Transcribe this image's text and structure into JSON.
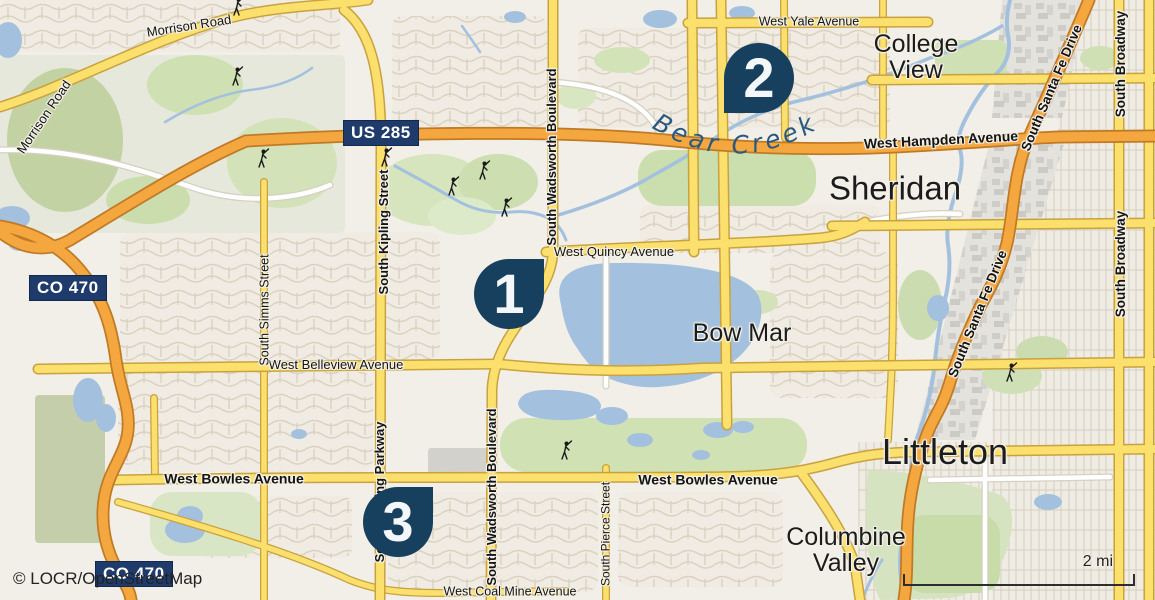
{
  "map": {
    "attribution": "© LOCR/OpenStreetMap",
    "scale": {
      "label": "2 mi"
    },
    "markers": [
      {
        "number": "1"
      },
      {
        "number": "2"
      },
      {
        "number": "3"
      }
    ],
    "shields": {
      "us285": "US 285",
      "co470_north": "CO 470",
      "co470_south": "CO 470"
    },
    "places": {
      "college_view": "College View",
      "sheridan": "Sheridan",
      "bow_mar": "Bow Mar",
      "littleton": "Littleton",
      "columbine_valley": "Columbine Valley"
    },
    "water_labels": {
      "bear_creek": "Bear Creek"
    },
    "road_labels": {
      "morrison_road_nw": "Morrison Road",
      "morrison_road_w": "Morrison Road",
      "west_yale_avenue": "West Yale Avenue",
      "west_hampden_avenue": "West Hampden Avenue",
      "west_quincy_avenue": "West Quincy Avenue",
      "west_belleview_avenue": "West Belleview Avenue",
      "west_bowles_avenue_w": "West Bowles Avenue",
      "west_bowles_avenue_e": "West Bowles Avenue",
      "west_coal_mine_avenue": "West Coal Mine Avenue",
      "south_simms_street": "South Simms Street",
      "south_kipling_street": "South Kipling Street",
      "south_kipling_parkway": "South Kipling Parkway",
      "south_wadsworth_boulevard_n": "South Wadsworth Boulevard",
      "south_wadsworth_boulevard_s": "South Wadsworth Boulevard",
      "south_pierce_street": "South Pierce Street",
      "south_santa_fe_drive_n": "South Santa Fe Drive",
      "south_santa_fe_drive_s": "South Santa Fe Drive",
      "south_broadway_n": "South Broadway",
      "south_broadway_s": "South Broadway"
    },
    "colors": {
      "marker": "#17405E",
      "shield": "#1F3B6B",
      "water": "#A3C1DE",
      "highway_orange": "#F5A73F",
      "road_yellow": "#FBE06E",
      "park_green": "#CDDDB2",
      "land": "#F2EFE8"
    }
  }
}
